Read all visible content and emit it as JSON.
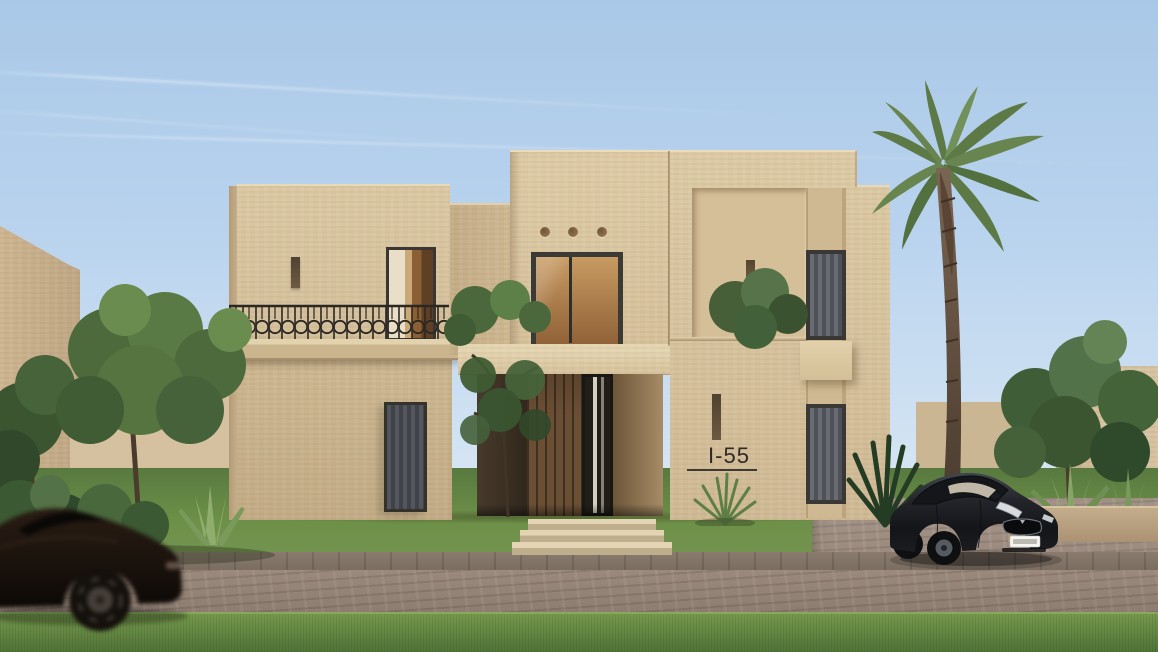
{
  "scene": {
    "type": "architectural-exterior-render",
    "house_number": "I-55",
    "description": "Two-storey sand-toned desert villa with recessed wood entry, balcony with iron railing, palm tree, parked electric sedan and a passing blurred car"
  },
  "colors": {
    "sky_top": "#a9c8e7",
    "sky_horizon": "#e7f0f7",
    "facade_sunlit": "#dcc9a5",
    "facade_shaded": "#b79f7c",
    "window_frame": "#3a3834",
    "curtain_gray": "#5e6268",
    "door_wood": "#6b4f35",
    "porch_shadow": "#32281d",
    "interior_warm": "#c89a62",
    "railing_iron": "#2b2723",
    "lawn_green": "#6d9048",
    "foliage_dark": "#3f5c34",
    "palm_frond": "#5d7a46",
    "palm_trunk": "#6d5947",
    "road_cobble": "#95847a",
    "driveway_cobble": "#a29185",
    "parked_car_body": "#1d1f24",
    "passing_car_body": "#1a120c",
    "license_plate": "#f4f4f0"
  }
}
